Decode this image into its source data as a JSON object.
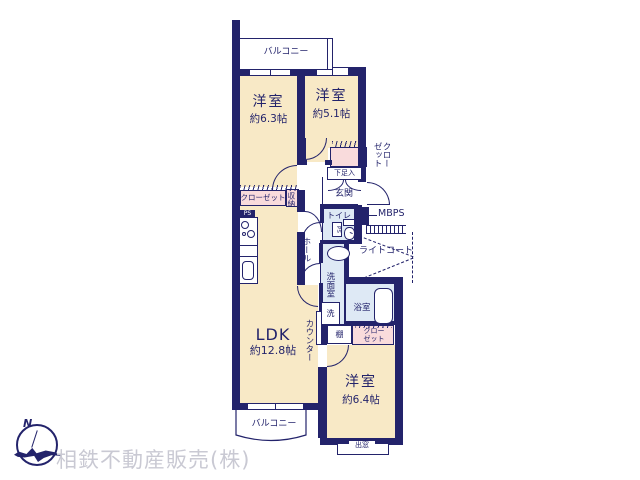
{
  "colors": {
    "wall": "#23236B",
    "room_fill": "#F8E9C6",
    "closet_fill": "#F9DBDC",
    "wet_fill": "#DEE9F5",
    "brand_gray": "#C9C9D3",
    "background": "#FFFFFF"
  },
  "company": {
    "name": "相鉄不動産販売(株)"
  },
  "compass": {
    "north_label": "N"
  },
  "balconies": {
    "top": "バルコニー",
    "bottom": "バルコニー"
  },
  "rooms": {
    "bedroom_a": {
      "name": "洋室",
      "size": "約6.3帖"
    },
    "bedroom_b": {
      "name": "洋室",
      "size": "約5.1帖"
    },
    "ldk": {
      "name": "LDK",
      "size": "約12.8帖"
    },
    "bedroom_c": {
      "name": "洋室",
      "size": "約6.4帖"
    }
  },
  "labels": {
    "closet_a": "クローゼット",
    "closet_b": "クローゼット",
    "closet_c_line1": "クロー",
    "closet_c_line2": "ゼット",
    "storage": "収納",
    "shoe_cabinet": "下足入",
    "entrance": "玄関",
    "toilet": "トイレ",
    "hall": "ホール",
    "ps_kitchen": "PS",
    "ps_toilet": "PS",
    "mbps": "MBPS",
    "light_court": "ライトコート",
    "washroom": "洗面室",
    "laundry": "洗",
    "bath": "浴室",
    "shelf": "棚",
    "counter": "カウンター",
    "bay_window": "出窓"
  }
}
